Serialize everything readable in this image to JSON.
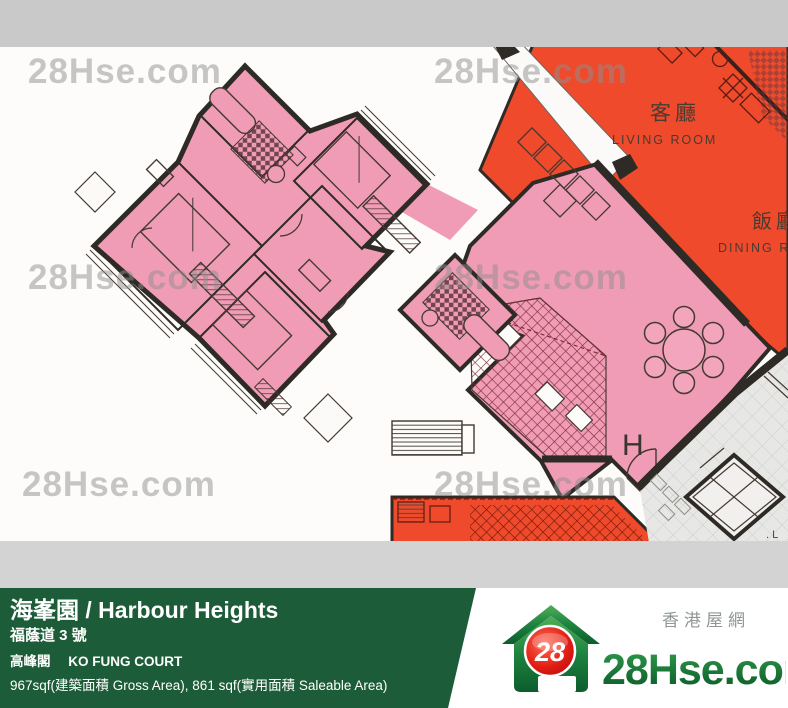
{
  "watermark": {
    "text": "28Hse.com"
  },
  "plan": {
    "living_room_cn": "客廳",
    "living_room_en": "LIVING ROOM",
    "dining_room_cn": "飯廳",
    "dining_room_en": "DINING R",
    "unit_label": "H",
    "lift_label": ". L",
    "colors": {
      "unit_pink": "#F09CB6",
      "neighbor_orange": "#EE4A2B",
      "wall": "#2E2A25",
      "lobby_gray": "#E7E7E5",
      "top_strip_gray": "#C9C9C9",
      "bottom_strip_gray": "#D3D3D3",
      "watermark_gray": "#8F8F8F"
    }
  },
  "footer": {
    "title": "海峯園 / Harbour Heights",
    "address": "福蔭道 3 號",
    "block_cn": "高峰閣",
    "block_en": "KO FUNG COURT",
    "area_info": "967sqf(建築面積 Gross Area), 861 sqf(實用面積 Saleable Area)",
    "bar_color": "#1D5C38",
    "logo": {
      "badge": "28",
      "brand": "28Hse.com",
      "tagline": "香港屋網"
    }
  }
}
